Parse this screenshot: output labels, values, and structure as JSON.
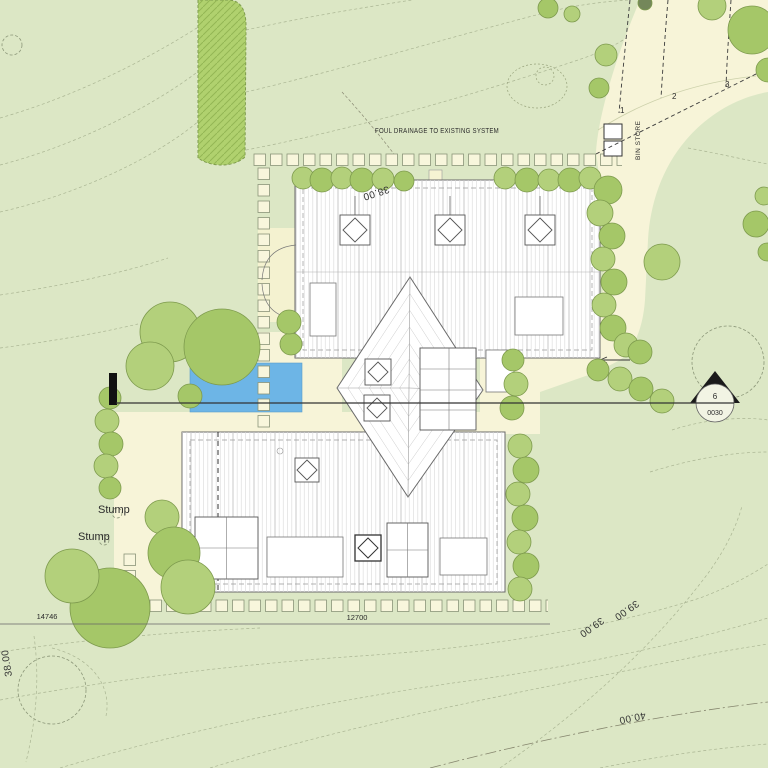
{
  "drawing": {
    "annotations": {
      "foul_drainage": "FOUL DRAINAGE TO EXISTING SYSTEM",
      "bin_store": "BIN STORE",
      "stump_upper": "Stump",
      "stump_lower": "Stump"
    },
    "parking_bays": {
      "bay_1": "1",
      "bay_2": "2",
      "bay_3": "3"
    },
    "section_marker": {
      "number": "6",
      "sheet": "0030"
    },
    "contour_labels": {
      "north_38": "38.00",
      "west_38": "38.00",
      "east_39_upper": "39.00",
      "east_39_lower": "39.00",
      "south_40": "40.00"
    },
    "dimensions": {
      "west_width": "14746",
      "south_width": "12700"
    },
    "colors": {
      "grass": "#dce7c5",
      "path": "#f7f4d8",
      "terrace": "#f4f2d0",
      "water": "#6db5e6",
      "canopy_light": "#b3d07b",
      "canopy_mid": "#a5c768",
      "canopy_dark": "#74875a",
      "canopy_stroke": "#7d9a4d",
      "hedge_strip": "#b0d16e",
      "roof": "#ffffff",
      "ink": "#1a1a1a"
    }
  }
}
